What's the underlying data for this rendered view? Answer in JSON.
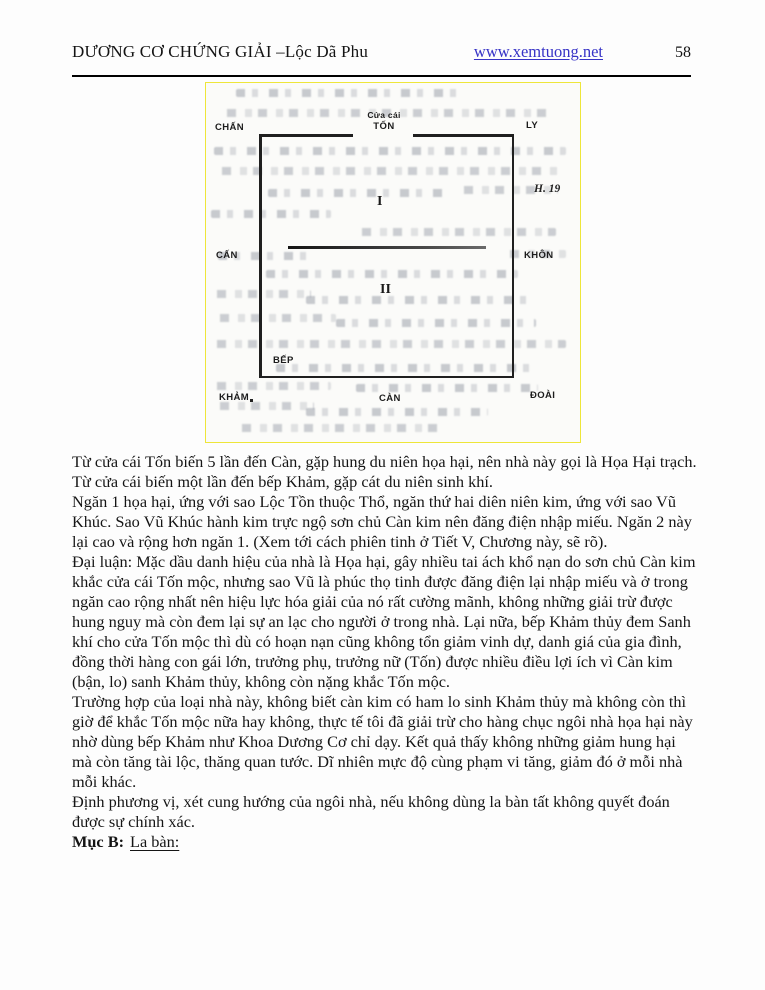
{
  "header": {
    "title": "DƯƠNG CƠ CHỨNG GIẢI –Lộc Dã Phu",
    "website": "www.xemtuong.net",
    "page_number": "58"
  },
  "figure": {
    "number": "H. 19",
    "door_caption_line1": "Cửa cái",
    "door_caption_line2": "TỐN",
    "labels": {
      "top_left": "CHẤN",
      "top_right": "LY",
      "mid_left": "CẤN",
      "mid_right": "KHÔN",
      "bottom_left": "KHẢM",
      "bottom_center": "CÀN",
      "bottom_right": "ĐOÀI",
      "kitchen": "BẾP",
      "section_1": "I",
      "section_2": "II"
    }
  },
  "body": {
    "paragraphs": [
      "Từ cửa cái Tốn biến 5 lần đến Càn, gặp hung du niên họa hại, nên nhà này gọi là Họa Hại trạch.",
      "Từ cửa cái biến một lần đến bếp Khảm, gặp cát du niên sinh khí.",
      "Ngăn 1 họa hại, ứng với sao Lộc Tồn thuộc Thổ, ngăn thứ hai diên niên kim, ứng với sao Vũ Khúc. Sao Vũ Khúc hành kim trực ngộ sơn chủ Càn kim nên đăng điện nhập miếu. Ngăn 2 này lại cao và rộng hơn ngăn 1. (Xem tới cách phiên tinh ở Tiết V, Chương này, sẽ rõ).",
      "Đại luận: Mặc dầu danh hiệu của nhà là Họa hại, gây nhiều tai ách khổ nạn do sơn chủ Càn kim khắc cửa cái Tốn mộc, nhưng sao Vũ là phúc thọ tinh được đăng điện lại nhập miếu và ở trong ngăn cao rộng nhất nên hiệu lực hóa giải của nó rất cường mãnh, không những giải trừ được hung nguy mà còn đem lại sự an lạc cho người ở trong nhà. Lại nữa, bếp Khảm thủy đem Sanh khí cho cửa Tốn mộc thì dù có hoạn nạn cũng không tổn giảm vinh dự, danh giá của gia đình, đồng thời hàng con gái lớn, trưởng phụ, trưởng nữ (Tốn) được nhiều điều lợi ích vì Càn kim (bận, lo) sanh Khảm thủy, không còn nặng khắc Tốn mộc.",
      "Trường hợp của loại nhà này, không biết càn kim có ham lo sinh Khảm thủy mà không còn thì giờ để khắc Tốn mộc nữa hay không, thực tế tôi đã giải trừ cho hàng chục ngôi nhà họa hại này nhờ dùng bếp Khảm như Khoa Dương Cơ chỉ dạy. Kết quả thấy không những giảm hung hại mà còn tăng tài lộc, thăng quan tước. Dĩ nhiên mực độ cùng phạm vi tăng, giảm đó ở mỗi nhà mỗi khác.",
      "Định phương vị, xét cung hướng của ngôi nhà, nếu không dùng la bàn tất không quyết đoán được sự chính xác."
    ]
  },
  "section_b": {
    "label": "Mục B:",
    "title": "La bàn:"
  },
  "colors": {
    "link_blue": "#3733c6",
    "scan_border_yellow": "#eee63a",
    "ink": "#1a1a1a"
  }
}
